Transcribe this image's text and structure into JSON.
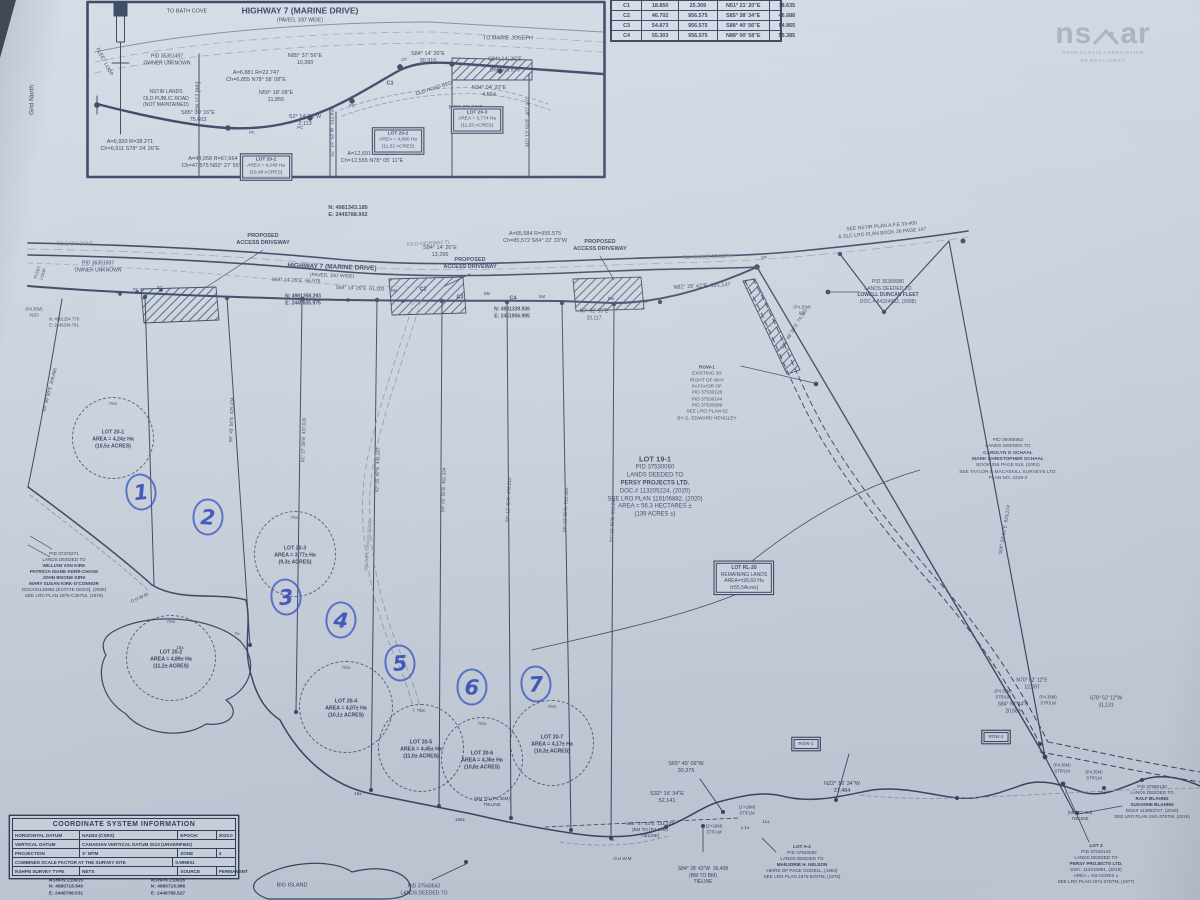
{
  "palette": {
    "paper": "#cdd5e0",
    "ink": "#313e5c",
    "faint": "#8793aa",
    "pen_blue": "#2b46bb",
    "logo_gray": "#a7afba"
  },
  "logo": {
    "mark_left": "ns",
    "mark_right": "ar",
    "line1": "NOVA SCOTIA ASSOCIATION",
    "line2": "OF REALTORS®"
  },
  "curve_table": {
    "rows": [
      [
        "C1",
        "18.850",
        "25.309",
        "N51° 21' 20\"E",
        "18.635"
      ],
      [
        "C2",
        "46.702",
        "956.575",
        "S85° 38' 34\"E",
        "46.688"
      ],
      [
        "C3",
        "54.873",
        "956.575",
        "S88° 40' 56\"E",
        "54.865"
      ],
      [
        "C4",
        "55.303",
        "956.575",
        "N88° 00' 58\"E",
        "55.385"
      ]
    ]
  },
  "coord_table": {
    "title": "COORDINATE SYSTEM INFORMATION",
    "rows": [
      [
        [
          "HORIZONTAL DATUM",
          28
        ],
        [
          "NAD83 (CSRS)",
          42
        ],
        [
          "EPOCH:",
          15
        ],
        [
          "2010.0",
          15
        ]
      ],
      [
        [
          "VERTICAL DATUM",
          28
        ],
        [
          "CANADIAN VERTICAL DATUM 2013 (UNVERIFIED)",
          72
        ]
      ],
      [
        [
          "PROJECTION",
          28
        ],
        [
          "3° MTM",
          42
        ],
        [
          "ZONE",
          15
        ],
        [
          "4",
          15
        ]
      ],
      [
        [
          "COMBINED SCALE FACTOR AT THE SURVEY SITE",
          70
        ],
        [
          "0.999931",
          30
        ]
      ],
      [
        [
          "NSHPN SURVEY TYPE",
          28
        ],
        [
          "NETS",
          42
        ],
        [
          "SOURCE",
          15
        ],
        [
          "PERMANENT",
          15
        ]
      ]
    ]
  },
  "map_labels": [
    {
      "t": "TO BATH COVE",
      "x": 187,
      "y": 12,
      "s": 5.5
    },
    {
      "t": "HIGHWAY 7 (MARINE DRIVE)",
      "x": 300,
      "y": 11,
      "s": 8.5,
      "b": 1,
      "n": "inset-highway-title"
    },
    {
      "t": "(PAVED, 100' WIDE)",
      "x": 300,
      "y": 21,
      "s": 5
    },
    {
      "t": "TO MARIE JOSEPH",
      "x": 508,
      "y": 39,
      "s": 5.5
    },
    {
      "t": "PID 35351497\nOWNER UNKNOWN",
      "x": 167,
      "y": 60,
      "s": 5
    },
    {
      "t": "FLEET LOOP",
      "x": 104,
      "y": 62,
      "s": 5,
      "r": 62
    },
    {
      "t": "NSTIR LANDS\nOLD PUBLIC ROAD\n(NOT MAINTAINED)",
      "x": 166,
      "y": 99,
      "s": 5
    },
    {
      "t": "N85° 37' 56\"E\n10,390",
      "x": 305,
      "y": 60,
      "s": 5.5
    },
    {
      "t": "A=6,881 R=22.747\nCh=6,855 N78° 58' 08\"E",
      "x": 256,
      "y": 77,
      "s": 5.5
    },
    {
      "t": "N59° 18' 08\"E\n11,855",
      "x": 276,
      "y": 97,
      "s": 5.5
    },
    {
      "t": "S85° 30' 16\"E\n75,603",
      "x": 198,
      "y": 117,
      "s": 5.5
    },
    {
      "t": "S2° 14' 53\"W\n2,113",
      "x": 305,
      "y": 121,
      "s": 5.5
    },
    {
      "t": "OLD ROAD BED",
      "x": 434,
      "y": 89,
      "s": 5,
      "r": -18
    },
    {
      "t": "C1",
      "x": 390,
      "y": 84,
      "s": 5.5,
      "b": 1
    },
    {
      "t": "S84° 14' 26\"E\n30,910",
      "x": 428,
      "y": 58,
      "s": 5.5
    },
    {
      "t": "S84° 14' 26\"E",
      "x": 505,
      "y": 60,
      "s": 5.5
    },
    {
      "t": "BM   69.576",
      "x": 505,
      "y": 71,
      "s": 5.5
    },
    {
      "t": "N34° 04' 20\"E\n4,554",
      "x": 489,
      "y": 92,
      "s": 5.5
    },
    {
      "t": "N70° 32' 31\"E\n20,759",
      "x": 466,
      "y": 112,
      "s": 5.5
    },
    {
      "t": "28,117 [99']",
      "x": 199,
      "y": 96,
      "s": 5.5,
      "r": -90
    },
    {
      "t": "S2° 14' 53\"W  312,620",
      "x": 333,
      "y": 132,
      "s": 5,
      "r": -90
    },
    {
      "t": "N7° 12' 50\"E  407,407",
      "x": 529,
      "y": 122,
      "s": 5,
      "r": -90
    },
    {
      "t": "A=6,920 R=38.271\nCh=6,911 S78° 24' 26\"E",
      "x": 130,
      "y": 146,
      "s": 5.5
    },
    {
      "t": "A=48,058 R=67,664\nCh=47,575 N82° 27' 55\"E",
      "x": 213,
      "y": 163,
      "s": 5.5
    },
    {
      "t": "A=12,691 R=47,608\nCh=12,555 N78° 05' 11\"E",
      "x": 372,
      "y": 158,
      "s": 5.5
    },
    {
      "lines": [
        {
          "t": "LOT 20-1",
          "b": 1
        },
        "AREA = 4,240 Ha",
        "(10,48 ACRES)"
      ],
      "x": 266,
      "y": 167,
      "s": 4.8,
      "box": 1,
      "n": "inset-lot-20-1"
    },
    {
      "lines": [
        {
          "t": "LOT 20-2",
          "b": 1
        },
        "AREA = 4,890 Ha",
        "(11,32 ACRES)"
      ],
      "x": 398,
      "y": 141,
      "s": 4.8,
      "box": 1,
      "n": "inset-lot-20-2"
    },
    {
      "lines": [
        {
          "t": "LOT 20-3",
          "b": 1
        },
        "AREA = 3,774 Ha",
        "(11,33 ACRES)"
      ],
      "x": 477,
      "y": 120,
      "s": 4.8,
      "box": 1,
      "n": "inset-lot-20-3"
    },
    {
      "t": "Grid North",
      "x": 33,
      "y": 100,
      "s": 6.5,
      "r": -90,
      "n": "grid-north-label"
    },
    {
      "t": "PC",
      "x": 252,
      "y": 133,
      "s": 4.2
    },
    {
      "t": "PC",
      "x": 300,
      "y": 128,
      "s": 4.2
    },
    {
      "t": "PC",
      "x": 352,
      "y": 106,
      "s": 4.2
    },
    {
      "t": "CP",
      "x": 404,
      "y": 60,
      "s": 4.2
    },
    {
      "t": "N: 4981343.185\nE: 2445788.902",
      "x": 348,
      "y": 212,
      "s": 5.5,
      "b": 1,
      "n": "coordinate-callout"
    },
    {
      "t": "SEE NSTIR PLAN A.F.E 33-400\n& SLC LRO PLAN BOOK 26 PAGE 147",
      "x": 882,
      "y": 230,
      "s": 5,
      "r": -5
    },
    {
      "t": "PROPOSED\nACCESS DRIVEWAY",
      "x": 263,
      "y": 240,
      "s": 5.5,
      "b": 1
    },
    {
      "t": "PROPOSED\nACCESS DRIVEWAY",
      "x": 470,
      "y": 264,
      "s": 5.5,
      "b": 1
    },
    {
      "t": "PROPOSED\nACCESS DRIVEWAY",
      "x": 600,
      "y": 246,
      "s": 5.5,
      "b": 1
    },
    {
      "t": "(OLD HIGHWAY 7)",
      "x": 428,
      "y": 244,
      "s": 5,
      "r": -3,
      "c": "#6d7a94"
    },
    {
      "t": "HIGHWAY 7 (MARINE DRIVE)",
      "x": 332,
      "y": 268,
      "s": 6.5,
      "b": 1,
      "r": 2
    },
    {
      "t": "(PAVED, 100' WIDE)",
      "x": 332,
      "y": 277,
      "s": 4.8,
      "r": 2
    },
    {
      "t": "TO MARIE JOSEPH",
      "x": 708,
      "y": 258,
      "s": 5.5,
      "r": -2,
      "c": "#6d7a94"
    },
    {
      "t": "TO BATH COVE",
      "x": 75,
      "y": 245,
      "s": 5,
      "c": "#6d7a94"
    },
    {
      "t": "A=85,584 R=956.575\nCh=85,572 S84° 22' 33\"W",
      "x": 535,
      "y": 238,
      "s": 5.5
    },
    {
      "t": "S84° 14' 26\"E\n13,295",
      "x": 440,
      "y": 252,
      "s": 5.5
    },
    {
      "t": "N82° 25' 42\"E  191,147",
      "x": 702,
      "y": 287,
      "s": 5.5,
      "r": -3
    },
    {
      "t": "PID 36351697\nOWNER UNKNOWN",
      "x": 98,
      "y": 267,
      "s": 5
    },
    {
      "t": "S84° 14' 26\"E  66,576",
      "x": 296,
      "y": 281,
      "s": 5,
      "r": 2
    },
    {
      "t": "S84° 14' 26\"E  61,203",
      "x": 360,
      "y": 289,
      "s": 5,
      "r": 2
    },
    {
      "t": "N: 4981358.293\nE: 2445835.975",
      "x": 303,
      "y": 300,
      "s": 5,
      "b": 1
    },
    {
      "t": "N: 4981339.936\nE: 2451956.995",
      "x": 512,
      "y": 313,
      "s": 5,
      "b": 1
    },
    {
      "t": "C2",
      "x": 423,
      "y": 290,
      "s": 5.5,
      "b": 1
    },
    {
      "t": "C3",
      "x": 460,
      "y": 298,
      "s": 5.5,
      "b": 1
    },
    {
      "t": "C4",
      "x": 513,
      "y": 299,
      "s": 5.5,
      "b": 1
    },
    {
      "t": "BM",
      "x": 394,
      "y": 291,
      "s": 4.2
    },
    {
      "t": "BM",
      "x": 487,
      "y": 294,
      "s": 4.2
    },
    {
      "t": "BM",
      "x": 542,
      "y": 297,
      "s": 4.2
    },
    {
      "t": "BM",
      "x": 611,
      "y": 299,
      "s": 4.2
    },
    {
      "t": "PC",
      "x": 119,
      "y": 293,
      "s": 4.2
    },
    {
      "t": "PC",
      "x": 136,
      "y": 290,
      "s": 4.2
    },
    {
      "t": "PC",
      "x": 160,
      "y": 288,
      "s": 4.2
    },
    {
      "t": "CP",
      "x": 646,
      "y": 302,
      "s": 4.2
    },
    {
      "t": "GP",
      "x": 764,
      "y": 258,
      "s": 4.2
    },
    {
      "t": "N7° 02' 55\"E\n20,117",
      "x": 594,
      "y": 315,
      "s": 5
    },
    {
      "t": "(P4.35M)\n#153",
      "x": 34,
      "y": 312,
      "s": 4.2
    },
    {
      "t": "N: 4981254.778\nE: 2445334.781",
      "x": 64,
      "y": 322,
      "s": 4.2
    },
    {
      "t": "FLEET\nLOOP",
      "x": 40,
      "y": 273,
      "s": 4.2,
      "r": -70
    },
    {
      "lines": [
        "PID 35389080",
        "LANDS DEEDED TO",
        {
          "t": "LOWELL DUNCAN FLEET",
          "b": 1
        },
        "DOC.# 84324982, (2008)"
      ],
      "x": 888,
      "y": 292,
      "s": 5,
      "n": "lowell-fleet-parcel-label"
    },
    {
      "lines": [
        {
          "t": "ROW-1",
          "b": 1
        },
        "EXISTING 30'",
        "RIGHT OF WAY",
        "IN FAVOR OF",
        "PID 37530126",
        "PID 37530144",
        "PID 37530589",
        "SEE LRO PLAN 62",
        "BY G. EDWARD HENGLEY"
      ],
      "x": 707,
      "y": 394,
      "s": 4.8,
      "n": "row-1-note"
    },
    {
      "lines": [
        "PID 35088952",
        "LANDS DEEDED TO",
        {
          "t": "CAROLYN G SCHAAL",
          "b": 1
        },
        {
          "t": "MARK CHRISTOPHER SCHAAL",
          "b": 1
        },
        "BOOK 255 PAGE 918, (2004)",
        "SEE TAYLOR & MACASKILL SURVEYS LTD.",
        "PLAN NO. 2229-2"
      ],
      "x": 1008,
      "y": 460,
      "s": 4.8,
      "n": "schaal-parcel-label"
    },
    {
      "lines": [
        {
          "t": "LOT 19-1",
          "b": 1,
          "s": 7.5
        },
        "PID 37530060",
        "LANDS DEEDED TO",
        {
          "t": "PERSY PROJECTS LTD.",
          "b": 1
        },
        "DOC.# 113205224, (2020)",
        "SEE LRO PLAN 116106882, (2020)",
        "AREA = 56.3 HECTARES ±",
        "(139 ACRES ±)"
      ],
      "x": 655,
      "y": 487,
      "s": 6,
      "n": "lot-19-1-label"
    },
    {
      "lines": [
        {
          "t": "LOT RL-20",
          "b": 1
        },
        "REMAINING LANDS",
        "AREA=±26,60 Ha",
        "(±55,5Acres)"
      ],
      "x": 744,
      "y": 578,
      "s": 5,
      "box": 1,
      "n": "lot-rl-20-label"
    },
    {
      "lines": [
        "PID 37376271",
        "LANDS DEEDED TO",
        {
          "t": "WILLIAM VAN KIRK",
          "b": 1
        },
        {
          "t": "PATRICIA DIANE KERR-CHASE",
          "b": 1
        },
        {
          "t": "JOHN BOONE KIRK",
          "b": 1
        },
        {
          "t": "MARY SUSAN KIRK-O'CONNOR",
          "b": 1
        },
        "DOC#31145994 (ESTATE DEED), (2009)",
        "SEE LRO PLAN 1875-C38752, (1975)"
      ],
      "x": 64,
      "y": 575,
      "s": 4.6,
      "n": "kirk-parcel-label"
    },
    {
      "t": "S35° 46' 30\"E  74,381",
      "x": 795,
      "y": 330,
      "s": 4.8,
      "r": -58
    },
    {
      "t": "S06° 23' 51\"E  623,274",
      "x": 1006,
      "y": 530,
      "s": 4.8,
      "r": -80
    },
    {
      "t": "(P4.35M)\n811",
      "x": 802,
      "y": 310,
      "s": 4.2
    },
    {
      "t": "S0° 43' 54\"E  429,234",
      "x": 232,
      "y": 420,
      "s": 4.6,
      "r": -88
    },
    {
      "t": "S1° 27' 28\"E  437,026",
      "x": 304,
      "y": 440,
      "s": 4.6,
      "r": -88
    },
    {
      "t": "S2° 55' 42\"E  445,167",
      "x": 378,
      "y": 470,
      "s": 4.6,
      "r": -88
    },
    {
      "t": "S4° 02' 55\"E  462,334",
      "x": 444,
      "y": 490,
      "s": 4.6,
      "r": -88
    },
    {
      "t": "S5° 12' 45\"E  478,912",
      "x": 509,
      "y": 500,
      "s": 4.6,
      "r": -87
    },
    {
      "t": "S6° 02' 55\"E  512,165",
      "x": 566,
      "y": 510,
      "s": 4.6,
      "r": -87
    },
    {
      "t": "S7° 02' 55\"E  553,283",
      "x": 613,
      "y": 520,
      "s": 4.6,
      "r": -87
    },
    {
      "t": "S5° 09' 00\"E  309,666",
      "x": 50,
      "y": 390,
      "s": 4.6,
      "r": -75
    },
    {
      "t": "(8M WIDE GRAVEL ROAD)",
      "x": 368,
      "y": 545,
      "s": 4.2,
      "r": -85,
      "c": "#6d7a94"
    },
    {
      "t": "O.H.W.M.",
      "x": 140,
      "y": 598,
      "s": 4.5,
      "r": -25
    },
    {
      "t": "O.H.W.M.",
      "x": 623,
      "y": 859,
      "s": 4.5
    },
    {
      "t": "7±",
      "x": 237,
      "y": 634,
      "s": 4.5
    },
    {
      "t": "18±",
      "x": 180,
      "y": 648,
      "s": 4.5
    },
    {
      "t": "16±",
      "x": 358,
      "y": 794,
      "s": 4.5
    },
    {
      "t": "4±",
      "x": 612,
      "y": 840,
      "s": 4.5
    },
    {
      "t": "165±",
      "x": 460,
      "y": 820,
      "s": 4.5
    },
    {
      "t": "11±",
      "x": 766,
      "y": 822,
      "s": 4.5
    },
    {
      "t": "13±",
      "x": 1102,
      "y": 793,
      "s": 4.5
    },
    {
      "t": "1.1±",
      "x": 745,
      "y": 828,
      "s": 4.5
    },
    {
      "t": "S65° 45' 09\"W\n30,375",
      "x": 686,
      "y": 768,
      "s": 5.5
    },
    {
      "t": "N22° 16' 34\"W\n31,484",
      "x": 842,
      "y": 788,
      "s": 5.5
    },
    {
      "t": "S32° 16' 34\"E\n52,141",
      "x": 667,
      "y": 798,
      "s": 5.5
    },
    {
      "t": "S88° 37' 43\"E  131,133\n(BM TO (P4.35M)\nTIELINE)",
      "x": 650,
      "y": 830,
      "s": 4.6
    },
    {
      "t": "S84° 28' 43\"W  30,408\n(BM TO BM)\nTIELINE",
      "x": 703,
      "y": 876,
      "s": 5
    },
    {
      "t": "(2'×18M)\nST/FLM",
      "x": 714,
      "y": 829,
      "s": 4.2
    },
    {
      "t": "(1'×16M)\nST/FLM",
      "x": 747,
      "y": 810,
      "s": 4.2
    },
    {
      "t": "(P4.35M)\nSTR/LM",
      "x": 1003,
      "y": 694,
      "s": 4.2
    },
    {
      "t": "(P4.35M)\nSTR/LM",
      "x": 1048,
      "y": 700,
      "s": 4.2
    },
    {
      "t": "(P4.35M)\nSTR/LM",
      "x": 1062,
      "y": 768,
      "s": 4.2
    },
    {
      "t": "(P4.35M)\nSTR/LM",
      "x": 1094,
      "y": 775,
      "s": 4.2
    },
    {
      "t": "N70° 52' 12\"E\n12,097",
      "x": 1032,
      "y": 684,
      "s": 5
    },
    {
      "t": "S84° 53' 44\"E\n20,583",
      "x": 1013,
      "y": 708,
      "s": 5
    },
    {
      "t": "S78° 52' 12\"W\n31,131",
      "x": 1106,
      "y": 702,
      "s": 5
    },
    {
      "t": "ROW-2",
      "x": 996,
      "y": 737,
      "s": 4.5,
      "box": 1
    },
    {
      "t": "ROW-1",
      "x": 806,
      "y": 744,
      "s": 4.5,
      "box": 1
    },
    {
      "t": "(5M TO 6M)\nTIELINE",
      "x": 1080,
      "y": 816,
      "s": 4.6
    },
    {
      "t": "(BM TO (P4.35M)\nTIELINE",
      "x": 492,
      "y": 802,
      "s": 4.6
    },
    {
      "lines": [
        "PID 37595130",
        "LANDS DEEDED TO",
        {
          "t": "RALF BLAHNN",
          "b": 1
        },
        {
          "t": "SUSANNE BLAHNN",
          "b": 1
        },
        "DOC# 113653747, (2019)",
        "SEE LRO PLAN 19/1-37STM, (2019)"
      ],
      "x": 1152,
      "y": 802,
      "s": 4.6,
      "n": "blahnn-parcel-label"
    },
    {
      "lines": [
        {
          "t": "LOT 3",
          "b": 1
        },
        "PID 37530144",
        "LANDS DEEDED TO",
        {
          "t": "PERSY PROJECTS LTD.",
          "b": 1
        },
        "DOC. 113210991, (2019)",
        "AREA = 9,8 ACRES ±",
        "SEE LRO PLAN 1971-37STM, (1977)"
      ],
      "x": 1096,
      "y": 864,
      "s": 4.6,
      "n": "lot-3-label"
    },
    {
      "lines": [
        {
          "t": "LOT A-2",
          "b": 1
        },
        "PID 37530052",
        "LANDS DEEDED TO",
        {
          "t": "MARJORIE H. NELSON",
          "b": 1
        },
        "HEIRS OF PAGE GODELL, (1964)",
        "SEE LRO PLAN 1975-52STM, (1975)"
      ],
      "x": 802,
      "y": 862,
      "s": 4.6,
      "n": "lot-a-2-label"
    },
    {
      "t": "PID 37543543\nLANDS DEEDED TO",
      "x": 424,
      "y": 890,
      "s": 5
    },
    {
      "t": "BIG ISLAND",
      "x": 292,
      "y": 886,
      "s": 5.5
    },
    {
      "t": "NSHPN 210915\nN: 4980718.840\nE: 2448768.531",
      "x": 66,
      "y": 888,
      "s": 4.8,
      "b": 1,
      "n": "monument-coordinates"
    },
    {
      "t": "NSHPN 210916\nN: 4980718.986\nE: 2448788.527",
      "x": 168,
      "y": 888,
      "s": 4.8,
      "b": 1,
      "n": "monument-coordinates"
    }
  ],
  "lot_circles": [
    {
      "x": 112,
      "y": 437,
      "rx": 40,
      "ry": 40,
      "top": "75m",
      "lines": "LOT 20-1\nAREA = 4,24± Ha\n(10,5± ACRES)"
    },
    {
      "x": 294,
      "y": 553,
      "rx": 40,
      "ry": 42,
      "top": "75m",
      "lines": "LOT 20-3\nAREA = 3,77± Ha\n(9,3± ACRES)"
    },
    {
      "x": 170,
      "y": 657,
      "rx": 44,
      "ry": 42,
      "top": "75m",
      "lines": "LOT 20-2\nAREA = 4,89± Ha\n(11,2± ACRES)"
    },
    {
      "x": 345,
      "y": 706,
      "rx": 46,
      "ry": 45,
      "top": "75m",
      "lines": "LOT 20-4\nAREA = 4,07± Ha\n(10,1± ACRES)"
    },
    {
      "x": 420,
      "y": 747,
      "rx": 42,
      "ry": 43,
      "top": "75m",
      "lines": "LOT 20-5\nAREA = 4,45± Ha\n(11,0± ACRES)"
    },
    {
      "x": 481,
      "y": 758,
      "rx": 40,
      "ry": 41,
      "top": "75m",
      "lines": "LOT 20-6\nAREA = 4,36± Ha\n(10,8± ACRES)"
    },
    {
      "x": 551,
      "y": 742,
      "rx": 41,
      "ry": 42,
      "top": "75m",
      "lines": "LOT 20-7\nAREA = 4,17± Ha\n(10,3± ACRES)"
    }
  ],
  "pen_numbers": [
    {
      "n": "1",
      "x": 141,
      "y": 492,
      "r": -6
    },
    {
      "n": "2",
      "x": 208,
      "y": 517,
      "r": 4
    },
    {
      "n": "3",
      "x": 286,
      "y": 597,
      "r": -5
    },
    {
      "n": "4",
      "x": 341,
      "y": 620,
      "r": 6
    },
    {
      "n": "5",
      "x": 400,
      "y": 663,
      "r": -4
    },
    {
      "n": "6",
      "x": 472,
      "y": 687,
      "r": 3
    },
    {
      "n": "7",
      "x": 536,
      "y": 684,
      "r": -3
    }
  ]
}
